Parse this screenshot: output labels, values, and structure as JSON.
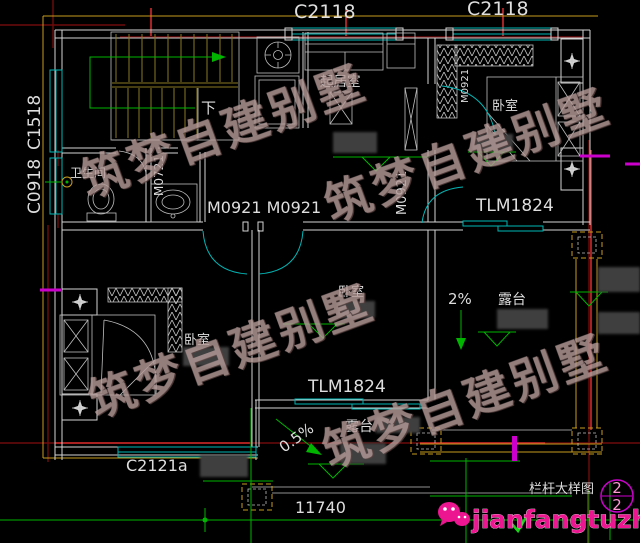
{
  "colors": {
    "background": "#000000",
    "wall": "#d4d4d4",
    "window_teal": "#00b6b6",
    "axis_red": "#6e0b0b",
    "axis_bright_red": "#cf2a2a",
    "cad_yellow": "#c99c1e",
    "stair_olive": "#8d7722",
    "dim_green": "#00b400",
    "magenta": "#cc00cc",
    "logo_pink": "#ec1690",
    "label_white": "#dedede",
    "watermark_gray_pink": "#b59a98",
    "censor_gray": "#3f3f3f"
  },
  "windows": {
    "top_left_label": "C2118",
    "top_right_label": "C2118",
    "left_upper_label": "C1518",
    "left_lower_label": "C0918",
    "bottom_label": "C2121a"
  },
  "rooms": {
    "living_room": "起居室",
    "bathroom": "卫生间",
    "bedroom_top_right": "卧室",
    "bedroom_middle": "卧室",
    "bedroom_left": "卧室",
    "terrace_right": "露台",
    "terrace_bottom": "露台"
  },
  "doors": {
    "bathroom_door": "M0721",
    "hall_double_doors": "M0921 M0921",
    "hall_vertical": "M0921",
    "bedroom_vertical": "M0921",
    "slider_right": "TLM1824",
    "slider_bottom": "TLM1824"
  },
  "annotations": {
    "stair_direction": "下",
    "slope_right": "2%",
    "slope_bottom": "0.5%",
    "overall_dimension": "11740",
    "railing_detail_title": "栏杆大样图",
    "sheet_number_top": "2",
    "sheet_number_bottom": "2"
  },
  "watermark": {
    "text": "筑梦自建别墅"
  },
  "logo": {
    "text": "jianfangtuzhi"
  }
}
